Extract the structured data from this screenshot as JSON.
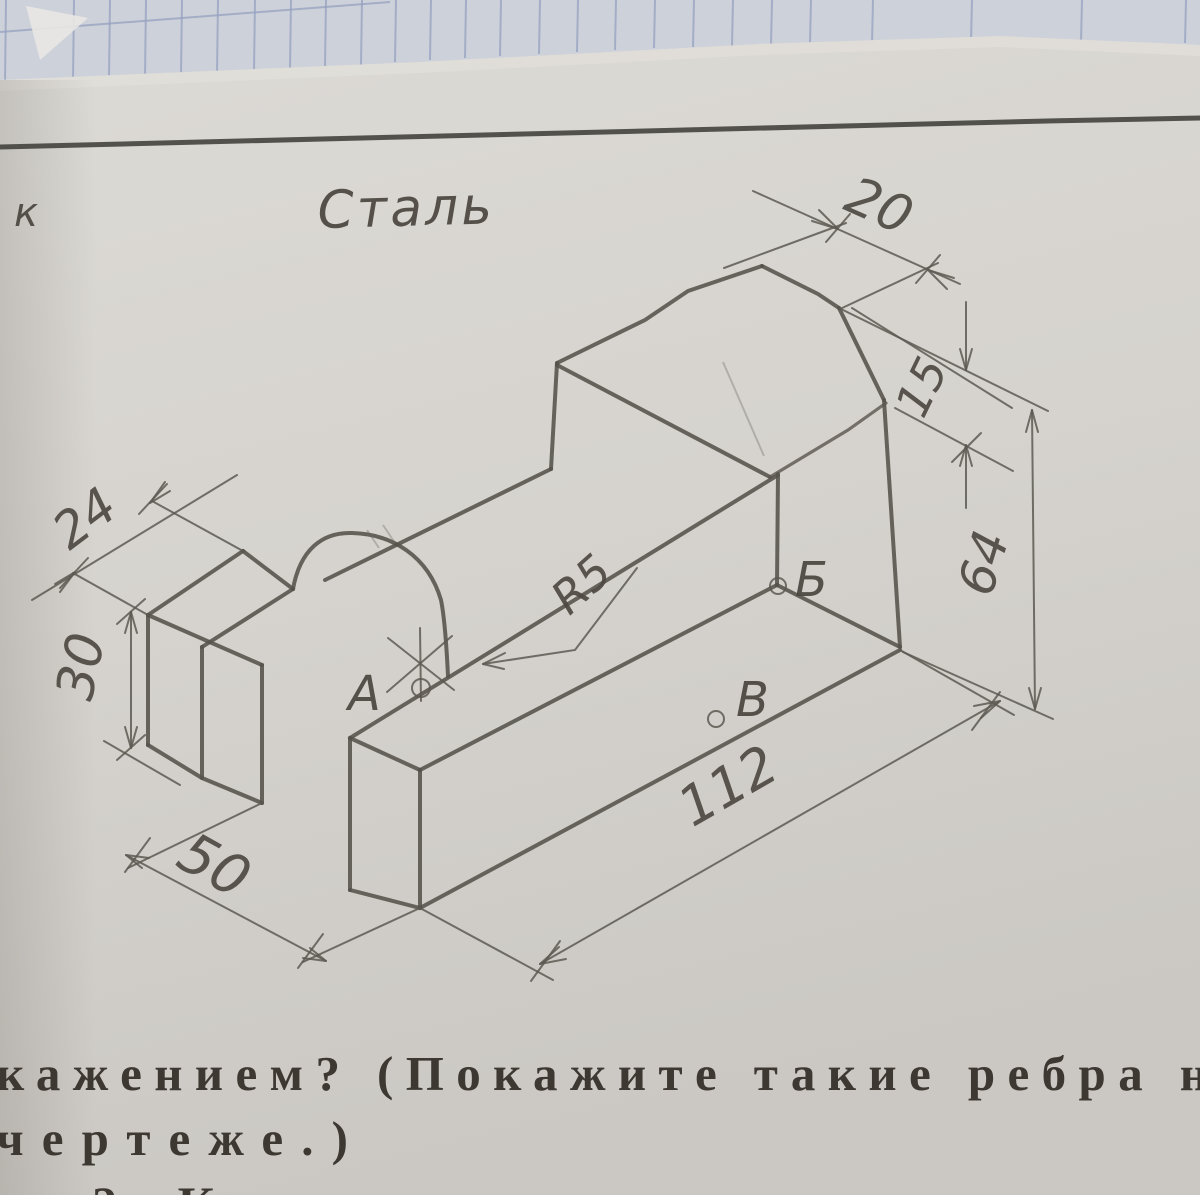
{
  "page": {
    "margin_letter": "к",
    "material_label": "Сталь"
  },
  "drawing": {
    "type": "isometric technical drawing of steel part",
    "dimensions": {
      "block_length": "24",
      "block_height": "30",
      "base_depth": "50",
      "total_length": "112",
      "tower_height": "64",
      "chamfer_drop": "15",
      "top_flat": "20",
      "slot_radius": "R5"
    },
    "points": {
      "a": "А",
      "b": "Б",
      "v": "В"
    }
  },
  "caption": {
    "line1": "кажением? (Покажите такие ребра н",
    "line2": "чертеже.)",
    "line3": "2. Каким точкам на наглядном из"
  },
  "colors": {
    "paper": "#d7d4cf",
    "grid_paper": "#cdd1da",
    "grid_line": "#96a2c0",
    "rule_line": "#44423d",
    "pencil": "#55524b",
    "print_ink": "#3d3932"
  }
}
